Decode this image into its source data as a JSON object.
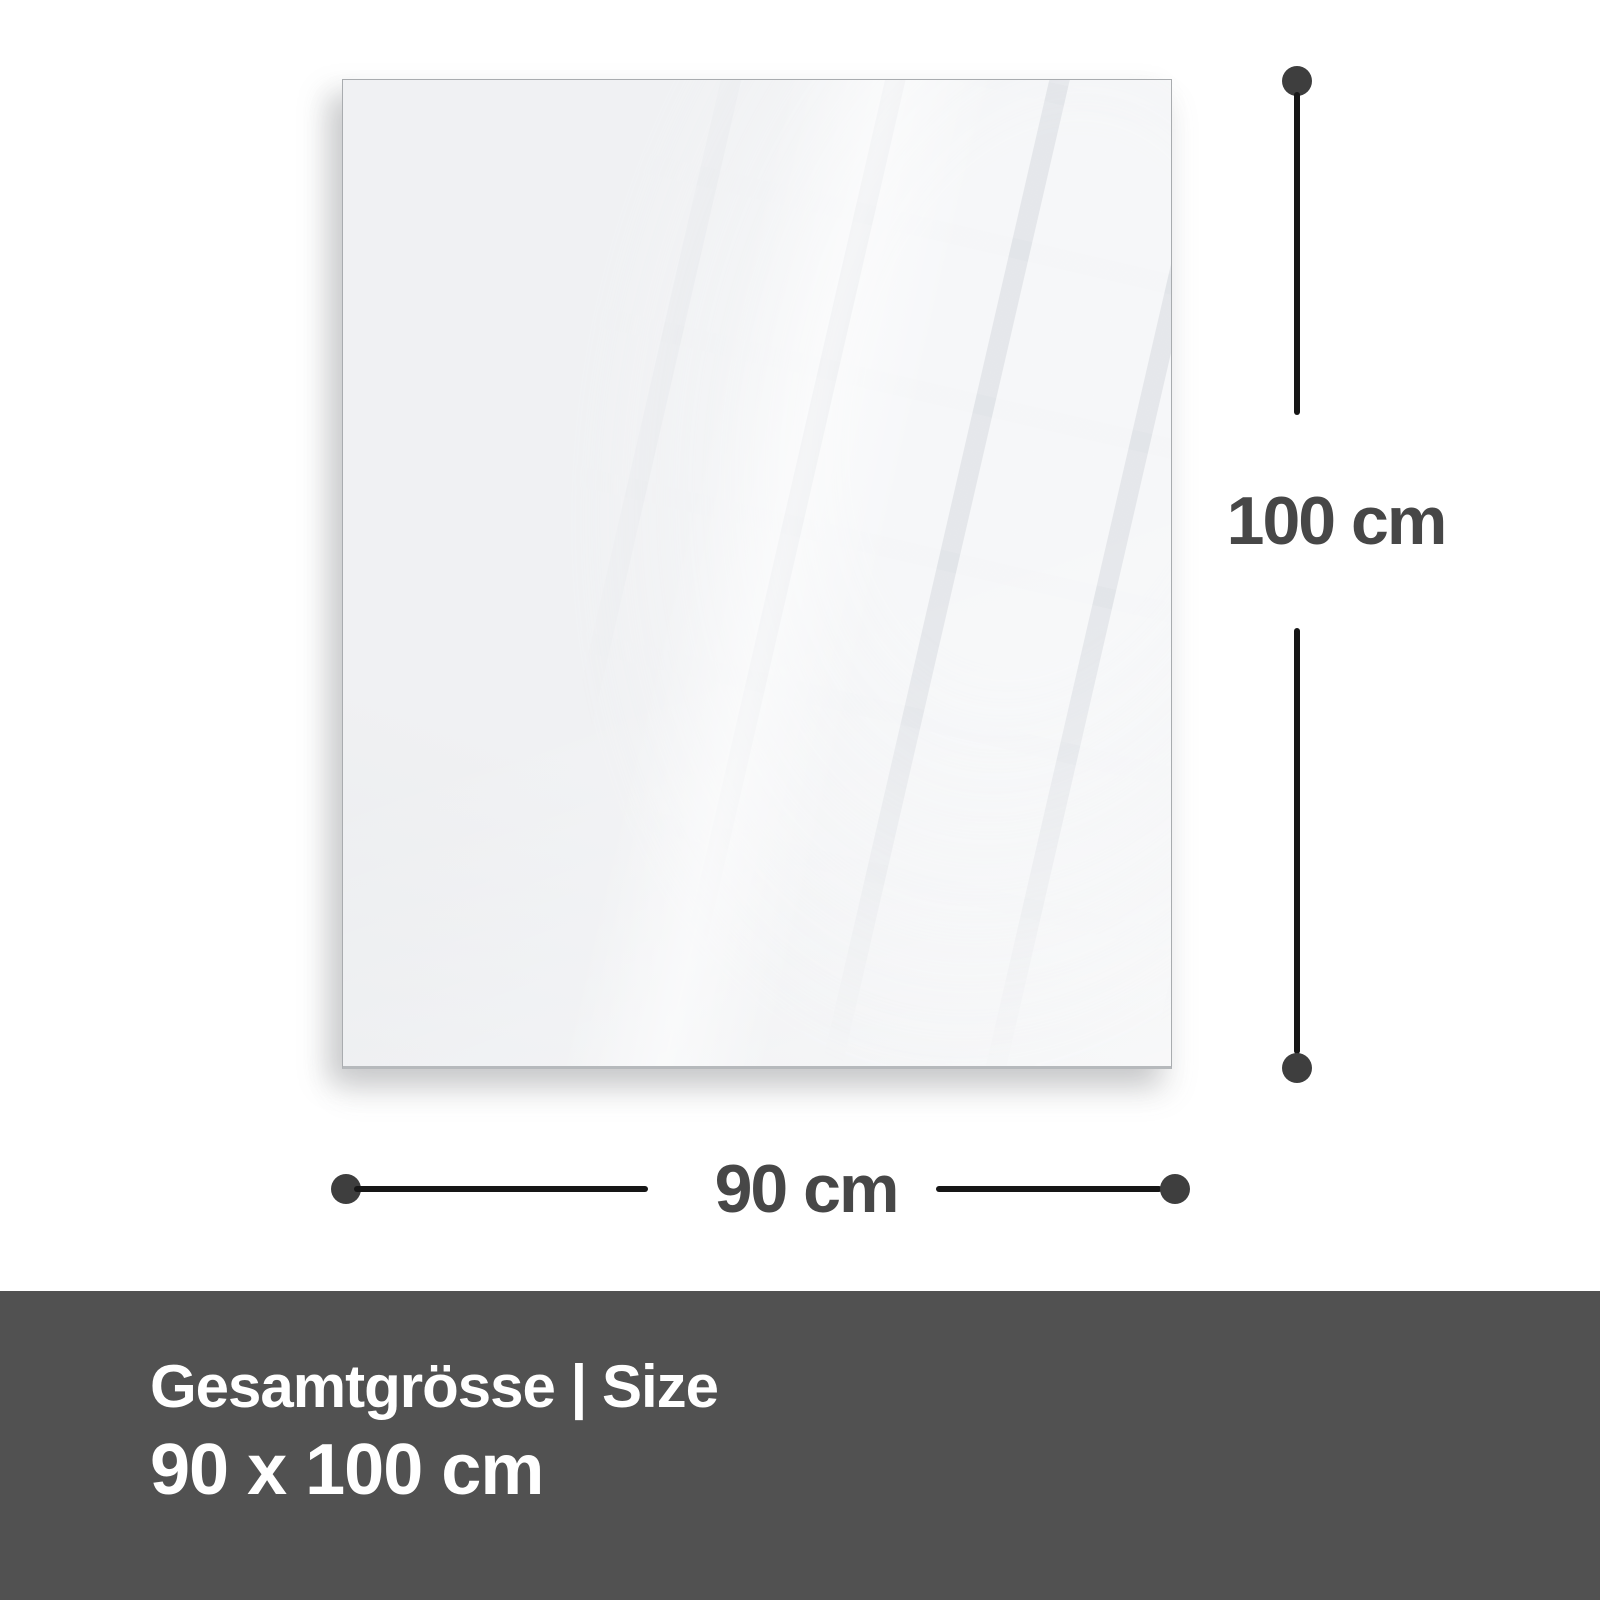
{
  "diagram": {
    "height_label": "100 cm",
    "width_label": "90 cm"
  },
  "footer": {
    "title": "Gesamtgrösse | Size",
    "size_value": "90 x 100 cm"
  },
  "colors": {
    "background": "#ffffff",
    "panel_fill": "#f0f1f3",
    "panel_border": "#a9acaf",
    "dimension_line": "#161616",
    "dimension_dot": "#3e3e3e",
    "dimension_label": "#474747",
    "footer_background": "#515151",
    "footer_text": "#ffffff"
  }
}
